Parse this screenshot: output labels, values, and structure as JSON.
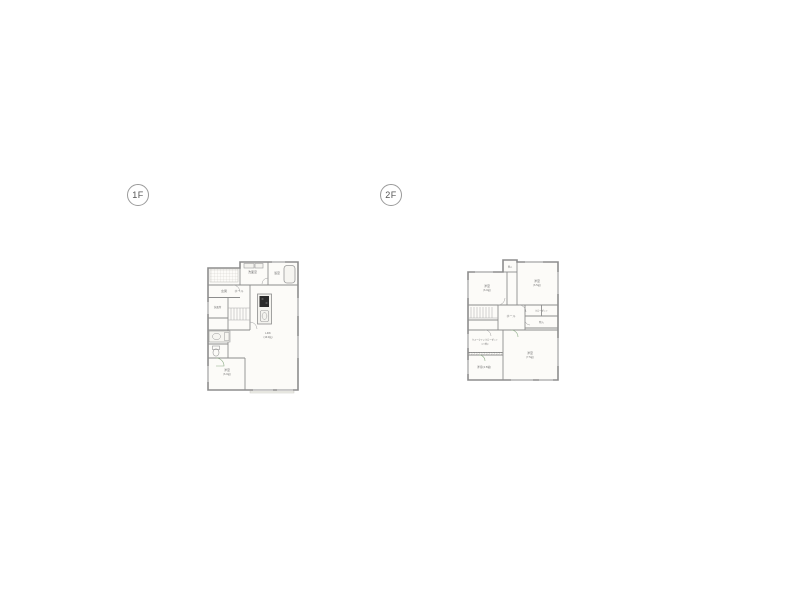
{
  "page": {
    "background": "#ffffff"
  },
  "colors": {
    "wall": "#8d8d8d",
    "room_fill": "#fcfbf8",
    "fixture": "#9a9a9a",
    "label": "#757575",
    "door_accent": "#8aab84",
    "stove": "#2b2b2b"
  },
  "floor1": {
    "badge": "1F",
    "rooms": {
      "ldk": {
        "name": "LDK",
        "size": "(16.0帖)"
      },
      "bath": {
        "name": "浴室"
      },
      "wash": {
        "name": "洗面室"
      },
      "entrance": {
        "name": "玄関"
      },
      "hall": {
        "name": "ホール"
      },
      "lavatory": {
        "name": "洗面所"
      },
      "bedroom": {
        "name": "洋室",
        "size": "(6.0帖)"
      }
    }
  },
  "floor2": {
    "badge": "2F",
    "rooms": {
      "top_storage": {
        "name": "物入"
      },
      "room_nw": {
        "name": "洋室",
        "size": "(6.0帖)"
      },
      "room_ne": {
        "name": "洋室",
        "size": "(6.5帖)"
      },
      "hall": {
        "name": "ホール"
      },
      "closet": {
        "name": "クローゼット"
      },
      "storage": {
        "name": "物入"
      },
      "wic": {
        "name": "ウォークインクローゼット",
        "size": "(2.0帖)"
      },
      "room_sw": {
        "name": "洋室(4.5帖)"
      },
      "room_se": {
        "name": "洋室",
        "size": "(7.5帖)"
      }
    }
  }
}
